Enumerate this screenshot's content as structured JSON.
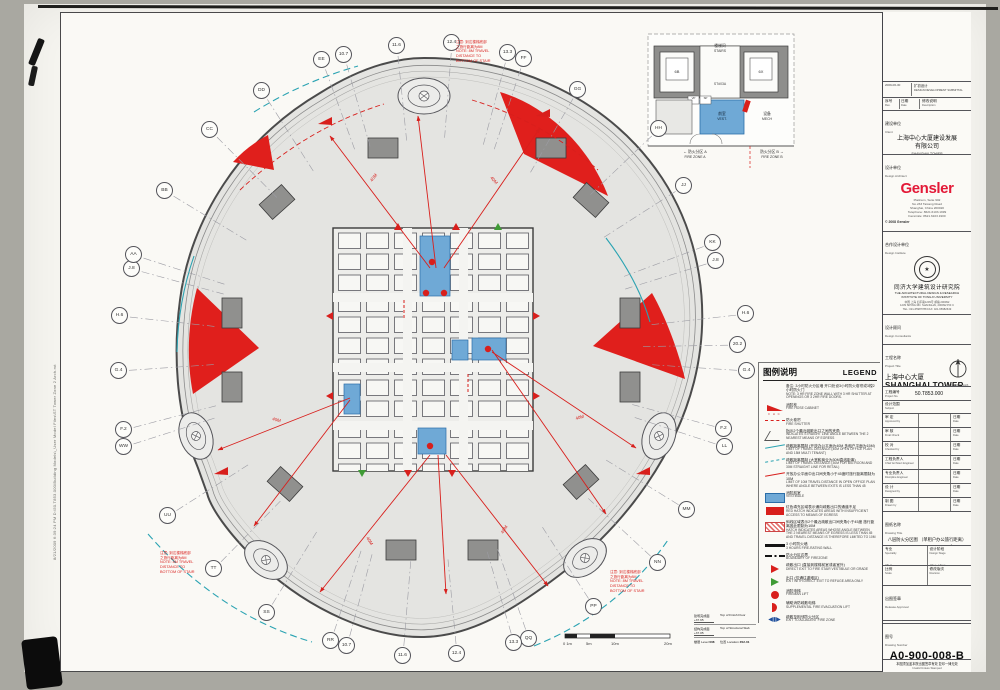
{
  "stamp": {
    "text": "8/21/2009 6:39:24 PM      D:\\50.T853.000\\Building Models\\_User Model Files\\ST Tower Zone 2 Arch.rvt"
  },
  "plan": {
    "grid_bubbles": [
      {
        "label": "EE",
        "x": 322,
        "y": 60
      },
      {
        "label": "10.7",
        "x": 344,
        "y": 55
      },
      {
        "label": "11.6",
        "x": 397,
        "y": 46
      },
      {
        "label": "12.4",
        "x": 452,
        "y": 43
      },
      {
        "label": "13.3",
        "x": 508,
        "y": 53
      },
      {
        "label": "FF",
        "x": 524,
        "y": 59
      },
      {
        "label": "GG",
        "x": 578,
        "y": 90
      },
      {
        "label": "HH",
        "x": 659,
        "y": 129
      },
      {
        "label": "JJ",
        "x": 684,
        "y": 186
      },
      {
        "label": "KK",
        "x": 713,
        "y": 243
      },
      {
        "label": "J.8",
        "x": 716,
        "y": 261
      },
      {
        "label": "H.6",
        "x": 746,
        "y": 314
      },
      {
        "label": "20.2",
        "x": 738,
        "y": 345
      },
      {
        "label": "G.4",
        "x": 747,
        "y": 371
      },
      {
        "label": "F.2",
        "x": 724,
        "y": 429
      },
      {
        "label": "LL",
        "x": 725,
        "y": 447
      },
      {
        "label": "MM",
        "x": 687,
        "y": 510
      },
      {
        "label": "NN",
        "x": 658,
        "y": 563
      },
      {
        "label": "PP",
        "x": 594,
        "y": 607
      },
      {
        "label": "QQ",
        "x": 529,
        "y": 639
      },
      {
        "label": "13.3",
        "x": 514,
        "y": 643
      },
      {
        "label": "12.4",
        "x": 457,
        "y": 654
      },
      {
        "label": "11.6",
        "x": 403,
        "y": 656
      },
      {
        "label": "10.7",
        "x": 347,
        "y": 646
      },
      {
        "label": "RR",
        "x": 331,
        "y": 641
      },
      {
        "label": "SS",
        "x": 267,
        "y": 613
      },
      {
        "label": "TT",
        "x": 214,
        "y": 569
      },
      {
        "label": "UU",
        "x": 168,
        "y": 516
      },
      {
        "label": "WW",
        "x": 124,
        "y": 447
      },
      {
        "label": "F.2",
        "x": 124,
        "y": 430
      },
      {
        "label": "G.4",
        "x": 119,
        "y": 371
      },
      {
        "label": "H.6",
        "x": 120,
        "y": 316
      },
      {
        "label": "J.8",
        "x": 132,
        "y": 269
      },
      {
        "label": "AA",
        "x": 134,
        "y": 255
      },
      {
        "label": "BB",
        "x": 165,
        "y": 191
      },
      {
        "label": "CC",
        "x": 210,
        "y": 130
      },
      {
        "label": "DD",
        "x": 262,
        "y": 91
      }
    ],
    "red_note": {
      "zh1": "注意: 到达楼梯底部",
      "zh2": "之旅行距离为8M",
      "en1": "NOTE: 8M TRAVEL",
      "en2": "DISTANCE TO",
      "en3": "BOTTOM OF STAIR"
    },
    "travel_label": "40M",
    "inset": {
      "stairs_zh": "楼梯间",
      "stairs_en": "STAIRS",
      "stair_id": "ST#03A",
      "lift_left": "6B",
      "lift_right": "6X",
      "vp": "VP",
      "sp": "SP",
      "vest_zh": "前室",
      "vest_en": "VEST.",
      "mech_zh": "设备",
      "mech_en": "MECH",
      "zone_a_zh": "防火分区 A",
      "zone_a_en": "FIRE ZONE A",
      "zone_b_zh": "防火分区 B",
      "zone_b_en": "FIRE ZONE B",
      "arrow_left": "←",
      "arrow_right": "→"
    },
    "scalebar": {
      "t0": "0 1m",
      "t1": "5m",
      "t2": "10m",
      "t3": "20m"
    },
    "levelinfo": {
      "finish_zh": "建筑完成面",
      "finish_val": "+37.65",
      "finish_en": "Top of Finish Floor",
      "slab_zh": "结构完成面",
      "slab_val": "+37.05",
      "slab_en": "Top of Structural Slab",
      "level_zh": "楼层",
      "level_en": "Level",
      "level_val": "008",
      "loc_zh": "位置",
      "loc_en": "Location",
      "loc_val": "Z02-01"
    }
  },
  "legend": {
    "title_zh": "图例说明",
    "title_en": "LEGEND",
    "items": [
      {
        "sym": "none",
        "zh": "备注: 3小时防火分区墙 开口处设3小时防火卷帘或3樘2小时防火门",
        "en": "NOTE: 3 HR FIRE ZONE WALL WITH 3 HR SHUTTER AT OPENINGS OR 3 2HR FIRE DOORS."
      },
      {
        "sym": "fhc",
        "sub": "F H C",
        "zh": "消防栓",
        "en": "FIRE HOSE CABINET"
      },
      {
        "sym": "shutter",
        "zh": "防火卷帘",
        "en": "FIRE SHUTTER"
      },
      {
        "sym": "angle",
        "zh": "指示2个最近疏散出口之间的夹角",
        "en": "INDICATES STRAIGHT LINE ANGLE BETWEEN THE 2 NEAREST MEANS OF EGRESS"
      },
      {
        "sym": "teal",
        "zh": "疏散距离限制 (开放办公平面为40M 多租户平面为15M)",
        "en": "LIMIT OF TRAVEL DISTANCE (40M OPEN OFFICE PLAN AND 15M MULTI TENANT)"
      },
      {
        "sym": "teal2",
        "zh": "疏散距离限制 (大堂和商业为30M直线距离)",
        "en": "LIMIT OF TRAVEL DISTANCE (30M FOR BIG ROOM AND 30M STRAIGHT LINE FOR RETAIL)"
      },
      {
        "sym": "redline",
        "zh": "开放办公平面中出口间夹角小于45度时旅行距离限制为10M",
        "en": "LIMIT OF 10M TRAVEL DISTANCE IN OPEN OFFICE PLAN WHERE ANGLE BETWEEN EXITS IS LESS THAN 45"
      },
      {
        "sym": "vest",
        "zh": "消防前室",
        "en": "VESTIBULE"
      },
      {
        "sym": "redfill",
        "zh": "红色填充区域表示通向疏散出口的通道不足",
        "en": "RED HATCH INDICATES AREAS WITH INSUFFICIENT ACCESS TO MEANS OF EGRESS"
      },
      {
        "sym": "redhatch",
        "zh": "斜线区域表示2个最近疏散出口间夹角小于45度 旅行距离因此限制为10M",
        "en": "HATCH INDICATES AREAS WHOSE ANGLE BETWEEN THE 2 NEAREST MEANS OF EGRESS IS LESS THAN 45 AND TRAVEL DISTANCE IS THEREFORE LIMITED TO 10M"
      },
      {
        "sym": "wall",
        "zh": "3 小时防火墙",
        "en": "3 HOURS FIRE-RATING WALL"
      },
      {
        "sym": "boundary",
        "zh": "防火分区边界",
        "en": "BOUNDARY OF FIREZONE"
      },
      {
        "sym": "exitred",
        "zh": "疏散出口 (直接到楼梯前室或者室外)",
        "en": "DIRECT EXIT TO FIRE STAIR VESTIBULE OR GRADE"
      },
      {
        "sym": "exitgreen",
        "zh": "出口 (仅通往避难区)",
        "en": "EXIT WITH DIRECT EXIT TO REFUGE AREA ONLY"
      },
      {
        "sym": "fireman",
        "zh": "消防电梯",
        "en": "FIREMAN LIFT"
      },
      {
        "sym": "supp",
        "zh": "辅助消防疏散电梯",
        "en": "SUPPLEMENTAL FIRE EVACUATION LIFT"
      },
      {
        "sym": "adjacent",
        "zh": "疏散至相邻防火分区",
        "en": "EXIT TO ADJACENT FIRE ZONE"
      }
    ]
  },
  "titleblock": {
    "submittal_date": "2009-06-30",
    "submittal_zh": "扩初设计",
    "submittal_en": "DESIGN DEVELOPMENT SUBMITTAL",
    "rev_zh": "序号",
    "rev_en": "Rev.",
    "date_zh": "日期",
    "date_en": "Date",
    "desc_zh": "修改说明",
    "desc_en": "Description",
    "client_zh": "建设单位",
    "client_en": "Client",
    "client_name_zh": "上海中心大厦建设发展",
    "client_name_zh2": "有限公司",
    "client_name_en1": "SHANGHAI TOWER",
    "client_name_en2": "CONSTRUCTION & DEVELOPMENT",
    "client_name_en3": "CO., LTD",
    "architect_zh": "设计单位",
    "architect_en": "Design Architect",
    "gensler": "Gensler",
    "gensler_addr1": "Platinum, Suite 902",
    "gensler_addr2": "No.233 Taicang Road",
    "gensler_addr3": "Shanghai, China  200020",
    "gensler_tel": "Telephone: 8621.6103.1999",
    "gensler_fax": "Facsimile: 8621.6103.1900",
    "gensler_copy": "© 2008 Gensler",
    "institute_zh": "合作设计单位",
    "institute_en": "Design Institute",
    "tongji_zh": "同济大学建筑设计研究院",
    "tongji_en1": "THE  ARCHITECTURAL  DESIGN  &  RESEARCH",
    "tongji_en2": "INSTITUTE  OF  TONGJI  UNIVERSITY",
    "tongji_addr_zh": "中国 上海 四平路1239号 邮编 200092",
    "tongji_addr_en": "1239 SIPING RD.  SHANGHAI, 200092  P.R.C",
    "tongji_tel": "TEL: 021-65987788   FAX: 021-65982649",
    "consultants_zh": "设计顾问",
    "consultants_en": "Design Consultants",
    "project_zh": "工程名称",
    "project_en": "Project Title",
    "project_name_zh": "上海中心大厦",
    "project_name_en": "SHANGHAI TOWER",
    "north_n": "N",
    "north_label": "North & Ref. North",
    "projno_zh": "工程编号",
    "projno_en": "Project No.",
    "projno_val": "50.T853.000",
    "subject_zh": "设计范围",
    "subject_en": "Subject",
    "approvals": [
      {
        "zh": "审  定",
        "en": "Approved by"
      },
      {
        "zh": "审  核",
        "en": "Final Check"
      },
      {
        "zh": "校  对",
        "en": "Checked by"
      },
      {
        "zh": "工程负责人",
        "en": "Chief Architect Engineer"
      },
      {
        "zh": "专业负责人",
        "en": "Discipline Engineer"
      },
      {
        "zh": "设  计",
        "en": "Designed by"
      },
      {
        "zh": "制  图",
        "en": "Drawn by"
      }
    ],
    "date_label_zh": "日期",
    "date_label_en": "Date",
    "dwgtitle_zh": "图纸名称",
    "dwgtitle_en": "Drawing Title",
    "dwgtitle_name_zh": "八层防火分区图 （单租户办公旅行距离）",
    "dwgtitle_name_en": "FIRE ZONE PLAN - LEVEL 008 (SINGLE TENANT TRAVEL DISTANCE)",
    "spec_zh": "专业",
    "spec_en": "Speciality",
    "spec_val_zh": "建筑",
    "spec_val_en": "ARCHITECTURE",
    "stage_zh": "设计阶段",
    "stage_en": "Design Stage",
    "stage_val_zh": "初步设计",
    "stage_val_en": "D.D.",
    "scale_zh": "比例",
    "scale_en": "Scale",
    "scale_a3": "A3 1:400",
    "scale_a1": "A1 1:200",
    "revision_zh": "修改版次",
    "revision_en": "Revision",
    "release_zh": "出图签章",
    "release_en": "Release Approval",
    "dwgno_zh": "图号",
    "dwgno_en": "Drawing Number",
    "dwgno_val": "A0-900-008-B",
    "valid_zh": "本图须加盖本院出图签章有效 复印一律无效",
    "valid_en": "Invalid Unless Stamped"
  }
}
